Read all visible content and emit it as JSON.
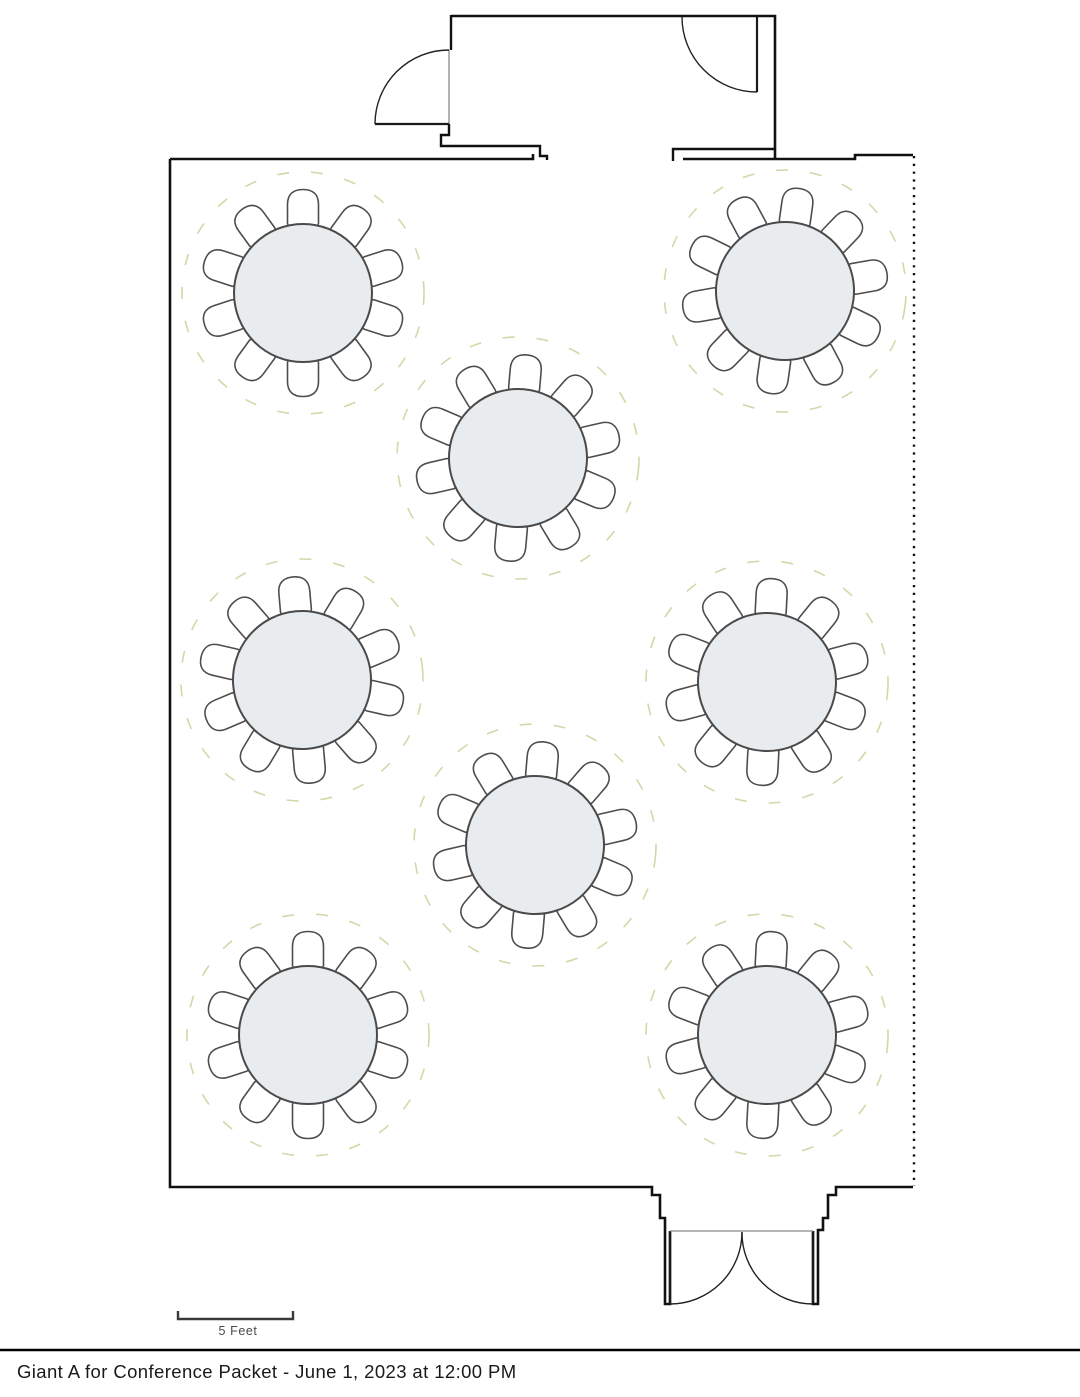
{
  "page": {
    "title": "Giant A for Conference Packet - June 1, 2023 at 12:00 PM"
  },
  "scale_bar": {
    "label": "5 Feet",
    "bracket_path": "M 178,1311 L 178,1319 L 293,1319 L 293,1311"
  },
  "floorplan": {
    "colors": {
      "wall": "#111111",
      "opening": "#8a8a8a",
      "door": "#1a1a1a",
      "door_swing": "#222222",
      "table_fill": "#e8ecef",
      "table_stroke": "#4a4a4a",
      "chair_fill": "#ffffff",
      "chair_stroke": "#4d4d4d",
      "spacing": "#c9d69e",
      "scale": "#3a3a3a"
    },
    "room": {
      "walls": [
        {
          "d": "M 170,159 L 170,1187 L 652,1187 L 652,1195 L 660,1195 L 660,1218 L 665,1218 L 665,1231 L 665,1304 L 670,1304 L 670,1231",
          "w": 2.6
        },
        {
          "d": "M 170,159 L 533,159 L 533,154",
          "w": 2.6
        },
        {
          "d": "M 449,124 L 449,135 L 441,135 L 441,146 L 540,146 L 540,156 L 547,156 L 547,160",
          "w": 2.4
        },
        {
          "d": "M 451,15 L 451,50",
          "w": 2.4
        },
        {
          "d": "M 451,16 L 775,16 L 775,158",
          "w": 2.6
        },
        {
          "d": "M 673,161 L 673,149 L 775,149",
          "w": 2.4
        },
        {
          "d": "M 683,159 L 855,159 L 855,155 L 913,155",
          "w": 2.6
        },
        {
          "d": "M 813,1231 L 813,1304 L 818,1304 L 818,1230 L 823,1230 L 823,1218 L 828,1218 L 828,1195 L 836,1195 L 836,1187 L 913,1187",
          "w": 2.6
        }
      ],
      "openings": [
        "M 449,50 L 449,124",
        "M 670,1231 L 813,1231"
      ],
      "air_wall": {
        "d": "M 914,156 L 914,1186",
        "w": 2.4,
        "dash": "2.2 5.6"
      },
      "doors": [
        {
          "leaf": "M 375,124 L 449,124",
          "swing": "M 375,124 A 74,74 0 0 1 449,50"
        },
        {
          "leaf": "M 757,17 L 757,92",
          "swing": "M 757,92 A 75,75 0 0 1 682,17"
        },
        {
          "leaf": "M 670,1232 L 670,1304",
          "swing": "M 670,1304 A 72,72 0 0 0 742,1232"
        },
        {
          "leaf": "M 813,1232 L 813,1304",
          "swing": "M 813,1304 A 71,71 0 0 1 742,1232"
        }
      ]
    },
    "table_spec": {
      "seats": 10,
      "table_radius": 69,
      "spacing_radius": 121,
      "chair_offset": 85,
      "chair_path": "M -15.5,15 L -15.5,-3.5 C -15.5,-13.5 -10,-18.5 0,-18.5 C 10,-18.5 15.5,-13.5 15.5,-3.5 L 15.5,15 Q 15.5,18 12.5,18 L -12.5,18 Q -15.5,18 -15.5,15 Z"
    },
    "tables": [
      {
        "id": "table-1",
        "x": 303,
        "y": 293,
        "rotation": 0
      },
      {
        "id": "table-2",
        "x": 785,
        "y": 291,
        "rotation": 8
      },
      {
        "id": "table-3",
        "x": 518,
        "y": 458,
        "rotation": 5
      },
      {
        "id": "table-4",
        "x": 302,
        "y": 680,
        "rotation": -5
      },
      {
        "id": "table-5",
        "x": 767,
        "y": 682,
        "rotation": 3
      },
      {
        "id": "table-6",
        "x": 535,
        "y": 845,
        "rotation": 5
      },
      {
        "id": "table-7",
        "x": 308,
        "y": 1035,
        "rotation": 0
      },
      {
        "id": "table-8",
        "x": 767,
        "y": 1035,
        "rotation": 3
      }
    ]
  }
}
